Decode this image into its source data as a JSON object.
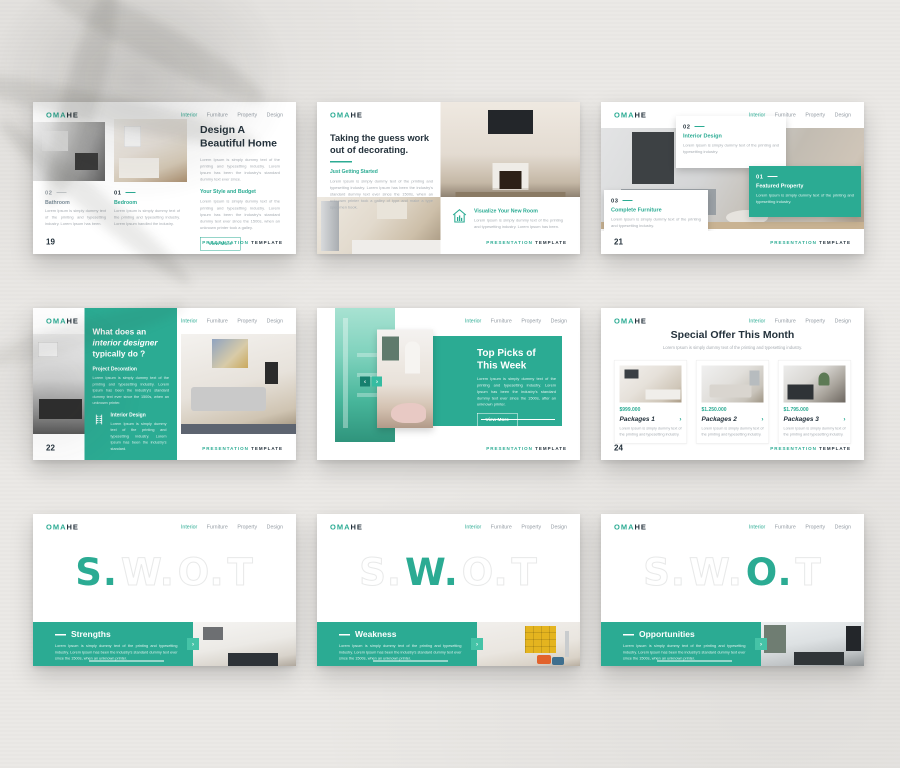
{
  "brand": {
    "logo_teal": "OMA",
    "logo_dark": "HE"
  },
  "nav": {
    "items": [
      "Interior",
      "Furniture",
      "Property",
      "Design"
    ],
    "active": "Interior"
  },
  "footer": {
    "word1": "PRESENTATION",
    "word2": "TEMPLATE"
  },
  "icons": {
    "chevron_left": "‹",
    "chevron_right": "›",
    "house": "house-chart-icon",
    "furniture": "shelf-comb-icon"
  },
  "colors": {
    "accent": "#2BAB93",
    "accent_dark": "#17806E",
    "ink": "#24323C",
    "muted": "#A6ACB2"
  },
  "slides": {
    "beautiful_home": {
      "page": "19",
      "title": "Design A Beautiful Home",
      "intro": "Lorem Ipsum is simply dummy text of the printing and typesetting industry. Lorem Ipsum has been the industry's standard dummy text ever since.",
      "subheading": "Your Style and Budget",
      "body": "Lorem Ipsum is simply dummy text of the printing and typesetting industry. Lorem Ipsum has been the industry's standard dummy text ever since the 1500s, when an unknown printer took a galley.",
      "button": "View More",
      "cards": [
        {
          "number": "02",
          "title": "Bathroom",
          "text": "Lorem Ipsum is simply dummy text of the printing and typesetting industry. Lorem Ipsum has been."
        },
        {
          "number": "01",
          "title": "Bedroom",
          "text": "Lorem Ipsum is simply dummy text of the printing and typesetting industry. Lorem Ipsum handled the industry."
        }
      ]
    },
    "guess_work": {
      "title": "Taking the guess work out of decorating.",
      "subheading": "Just Getting Started",
      "body": "Lorem Ipsum is simply dummy text of the printing and typesetting industry. Lorem Ipsum has been the industry's standard dummy text ever since the 1500s, when an unknown printer took a galley of type and make a type specimen book.",
      "feature_title": "Visualize Your New Room",
      "feature_body": "Lorem Ipsum is simply dummy text of the printing and typesetting industry. Lorem Ipsum has been."
    },
    "property_cards": {
      "page": "21",
      "cards": [
        {
          "number": "02",
          "title": "Interior Design",
          "text": "Lorem Ipsum is simply dummy text of the printing and typesetting industry."
        },
        {
          "number": "01",
          "title": "Featured Property",
          "text": "Lorem Ipsum is simply dummy text of the printing and typesetting industry."
        },
        {
          "number": "03",
          "title": "Complete Furniture",
          "text": "Lorem Ipsum is simply dummy text of the printing and typesetting industry."
        }
      ]
    },
    "designer_do": {
      "page": "22",
      "title_line1": "What does an",
      "title_line2": "interior designer",
      "title_line3": "typically do ?",
      "subheading1": "Project Decoration",
      "body1": "Lorem Ipsum is simply dummy text of the printing and typesetting industry. Lorem Ipsum has been the industry's standard dummy text ever since the 1500s, when an unknown printer.",
      "subheading2": "Interior Design",
      "body2": "Lorem Ipsum is simply dummy text of the printing and typesetting industry. Lorem Ipsum has been the industry's standard."
    },
    "top_picks": {
      "title": "Top Picks of This Week",
      "body": "Lorem Ipsum is simply dummy text of the printing and typesetting industry. Lorem Ipsum has been the industry's standard dummy text ever since the 1500s, after an unknown printer.",
      "button": "View More"
    },
    "special_offer": {
      "page": "24",
      "title": "Special Offer This Month",
      "subtitle": "Lorem Ipsum is simply dummy text of the printing and typesetting industry.",
      "packages": [
        {
          "price": "$999.000",
          "name": "Packages 1",
          "text": "Lorem Ipsum is simply dummy text of the printing and typesetting industry."
        },
        {
          "price": "$1.250.000",
          "name": "Packages 2",
          "text": "Lorem Ipsum is simply dummy text of the printing and typesetting industry."
        },
        {
          "price": "$1.795.000",
          "name": "Packages 3",
          "text": "Lorem Ipsum is simply dummy text of the printing and typesetting industry."
        }
      ]
    },
    "swot_strengths": {
      "heading": "Strengths",
      "body": "Lorem Ipsum is simply dummy text of the printing and typesetting industry. Lorem Ipsum has been the industry's standard dummy text ever since the 1500s, when an unknown printer."
    },
    "swot_weakness": {
      "heading": "Weakness",
      "body": "Lorem Ipsum is simply dummy text of the printing and typesetting industry. Lorem Ipsum has been the industry's standard dummy text ever since the 1500s, when an unknown printer."
    },
    "swot_opportunities": {
      "heading": "Opportunities",
      "body": "Lorem Ipsum is simply dummy text of the printing and typesetting industry. Lorem Ipsum has been the industry's standard dummy text ever since the 1500s, when an unknown printer."
    }
  },
  "swot": {
    "letters": [
      "S.",
      "W.",
      "O.",
      "T"
    ]
  }
}
